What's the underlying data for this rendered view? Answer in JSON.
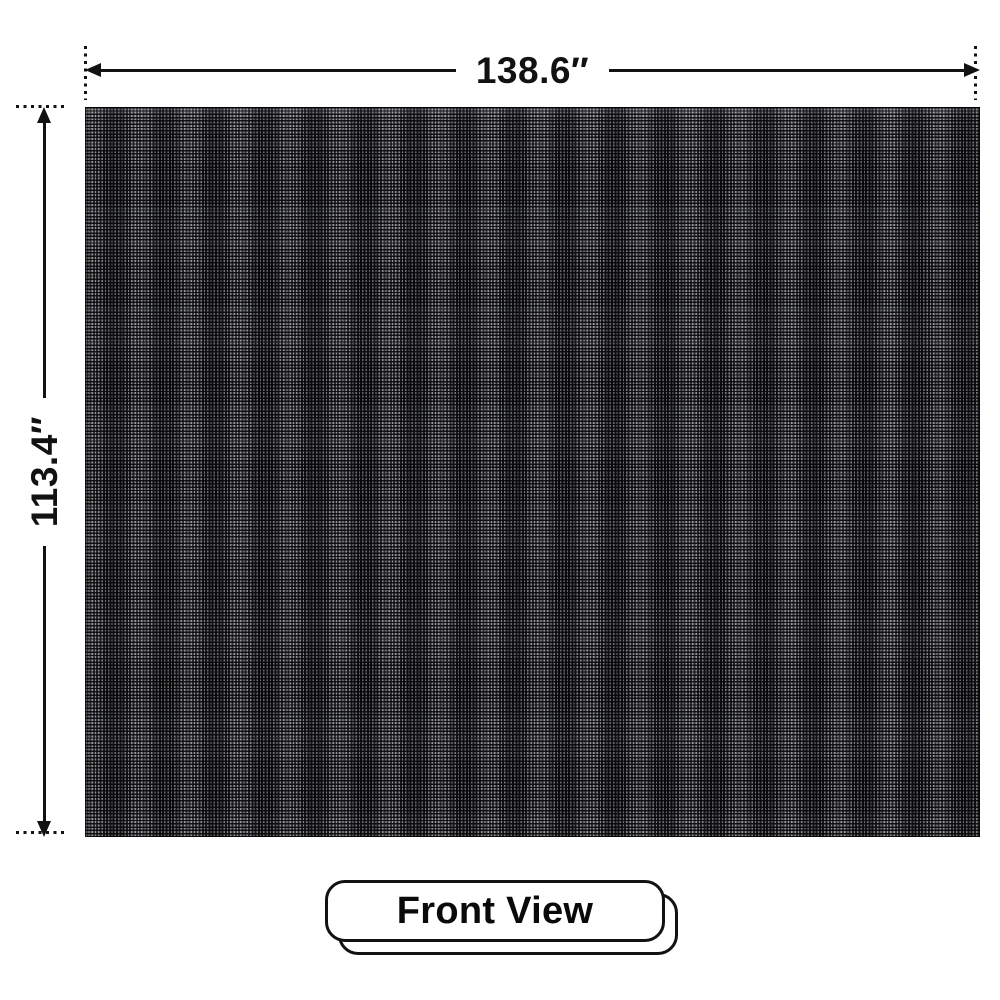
{
  "diagram": {
    "subject": "led-video-wall-front-view",
    "view": {
      "label": "Front View"
    },
    "dimensions": {
      "width": "138.6″",
      "height": "113.4″",
      "unit": "inches"
    }
  },
  "colors": {
    "background": "#ffffff",
    "annotation": "#121212",
    "panel_base": "#121214",
    "panel_led_dot": "#dee2ea",
    "panel_seam_tint": "#7887aa"
  }
}
